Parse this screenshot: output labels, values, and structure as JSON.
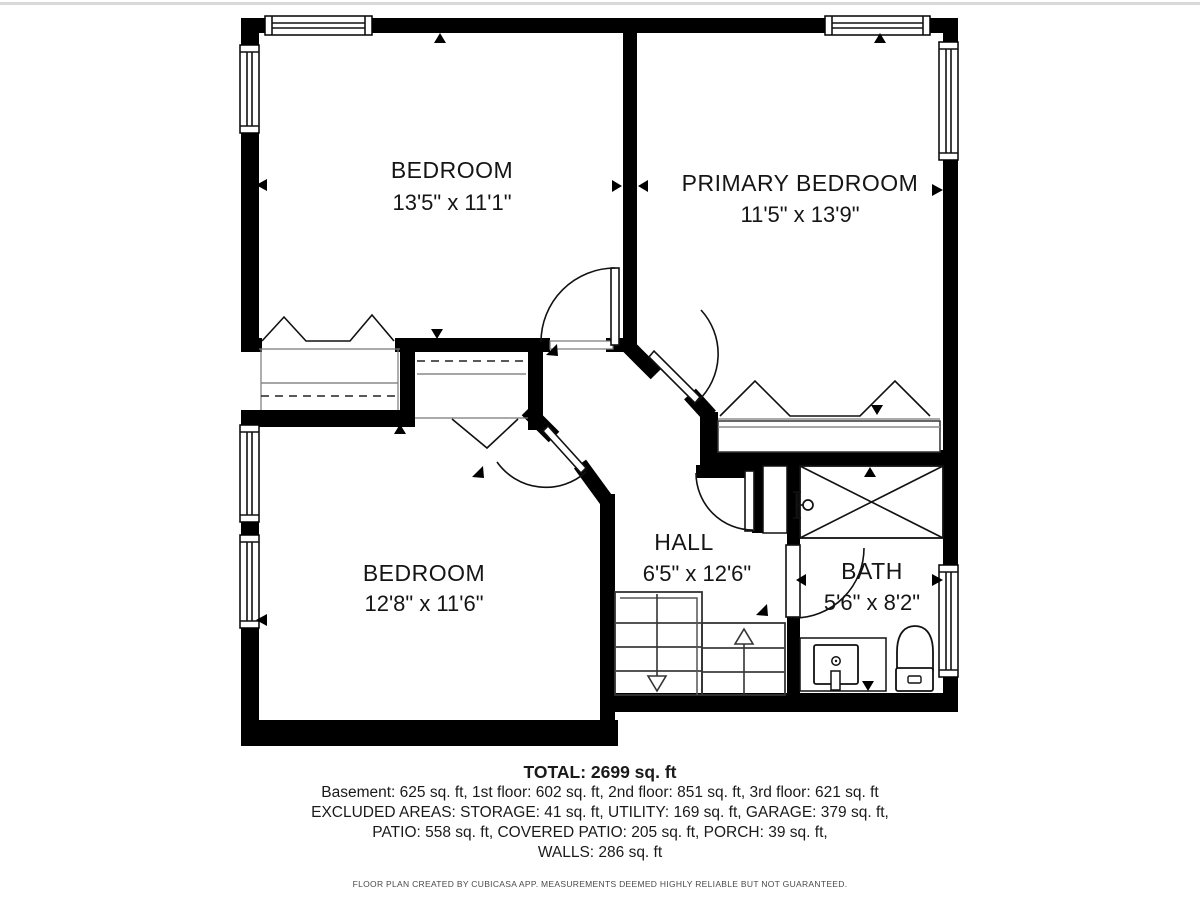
{
  "plan": {
    "rooms": [
      {
        "id": "bedroom-top-left",
        "name": "BEDROOM",
        "dims": "13'5\" x 11'1\""
      },
      {
        "id": "primary-bedroom",
        "name": "PRIMARY BEDROOM",
        "dims": "11'5\" x 13'9\""
      },
      {
        "id": "bedroom-bottom-left",
        "name": "BEDROOM",
        "dims": "12'8\" x 11'6\""
      },
      {
        "id": "hall",
        "name": "HALL",
        "dims": "6'5\" x 12'6\""
      },
      {
        "id": "bath",
        "name": "BATH",
        "dims": "5'6\" x 8'2\""
      }
    ],
    "summary": {
      "total": "TOTAL: 2699 sq. ft",
      "line1": "Basement: 625 sq. ft, 1st floor: 602 sq. ft, 2nd floor: 851 sq. ft, 3rd floor: 621 sq. ft",
      "line2": "EXCLUDED AREAS: STORAGE: 41 sq. ft, UTILITY: 169 sq. ft, GARAGE: 379 sq. ft,",
      "line3": "PATIO: 558 sq. ft, COVERED PATIO: 205 sq. ft, PORCH: 39 sq. ft,",
      "line4": "WALLS: 286 sq. ft"
    },
    "disclaimer": "FLOOR PLAN CREATED BY CUBICASA APP. MEASUREMENTS DEEMED HIGHLY RELIABLE BUT NOT GUARANTEED.",
    "colors": {
      "wall": "#000000",
      "background": "#ffffff",
      "text": "#1a1a1a",
      "muted": "#4a4a4a"
    },
    "symbols": [
      "window",
      "door-swing",
      "closet-sawtooth",
      "shower-x",
      "toilet",
      "vanity-sink",
      "stairs-up",
      "stairs-down"
    ]
  }
}
